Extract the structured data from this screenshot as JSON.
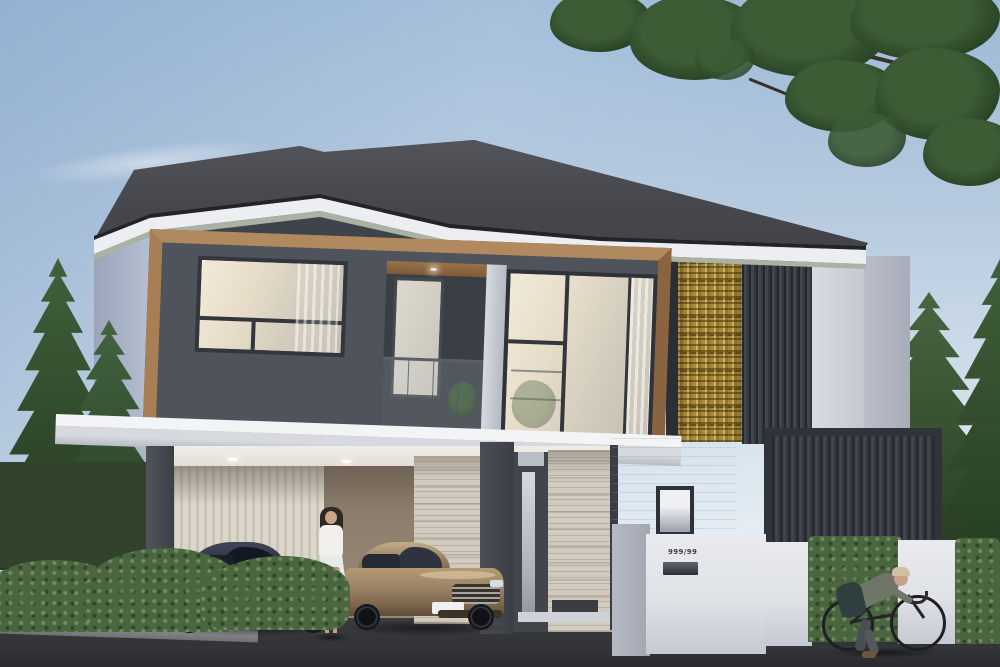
{
  "scene": {
    "title": "Modern two-storey house exterior rendering",
    "house_number": "999/99",
    "objects": [
      "hip roof",
      "wood-framed upper floor",
      "gold patterned screen",
      "slatted panel",
      "carport with two cars",
      "entry door",
      "woman with handbag",
      "cyclist",
      "pine trees",
      "hedge and white fence",
      "mail slot"
    ]
  },
  "colors": {
    "sky_top": "#9db9d7",
    "sky_horizon": "#eef3f7",
    "roof": "#45464c",
    "fascia": "#eceef2",
    "soffit": "#a9b2a3",
    "wall_dark": "#4f535b",
    "wood_frame": "#a57b50",
    "gold_screen": "#a8893c",
    "slat_panel": "#363a41",
    "wall_light": "#dfe2e7",
    "side_wall": "#a9b4c6",
    "travertine": "#d2ccc0",
    "carport_slats": "#d6d1c4",
    "asphalt": "#37393d",
    "hedge": "#49663f",
    "pine": "#31492c",
    "car_dark": "#2e3442",
    "car_bronze": "#9c8465",
    "dress": "#f2f0ec"
  }
}
